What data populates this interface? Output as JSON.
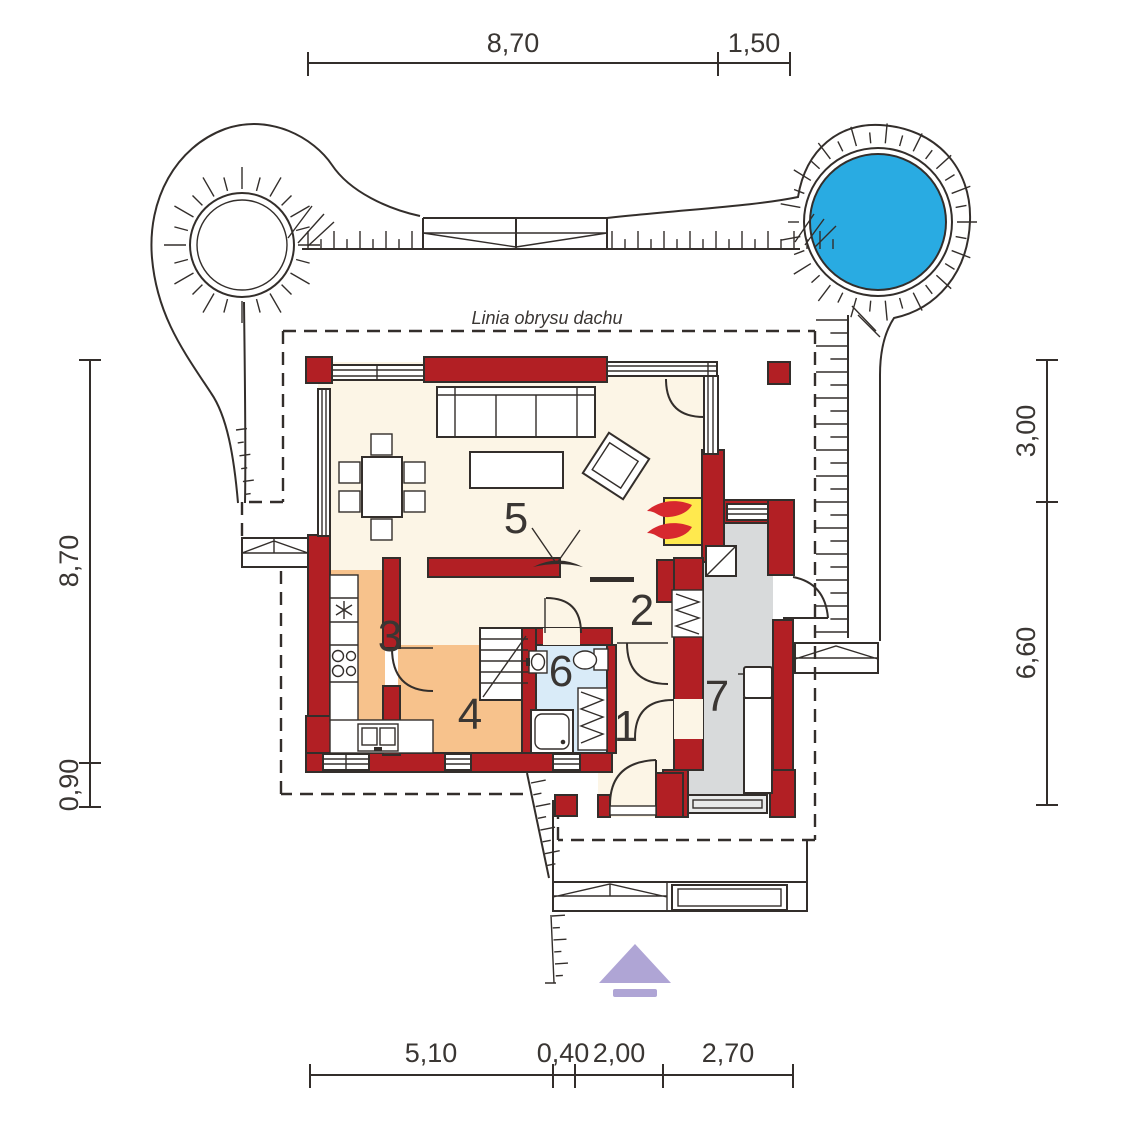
{
  "roof_label": "Linia obrysu dachu",
  "rooms": {
    "r1": "1",
    "r2": "2",
    "r3": "3",
    "r4": "4",
    "r5": "5",
    "r6": "6",
    "r7": "7"
  },
  "dims": {
    "top": [
      "8,70",
      "1,50"
    ],
    "left": [
      "8,70",
      "0,90"
    ],
    "right": [
      "3,00",
      "6,60"
    ],
    "bottom": [
      "5,10",
      "0,40",
      "2,00",
      "2,70"
    ]
  },
  "colors": {
    "line": "#332e2b",
    "text": "#3a3633",
    "wall": "#b21f24",
    "cream": "#fcf5e6",
    "orange": "#f7c28c",
    "bath": "#d9ebf8",
    "shower": "#cfe5f5",
    "garage": "#d8dadb",
    "garage_door": "#e9eaea",
    "pool": "#29abe2",
    "fire_yellow": "#ffe94e",
    "flame": "#d7282f",
    "arrow": "#afa5d5"
  }
}
